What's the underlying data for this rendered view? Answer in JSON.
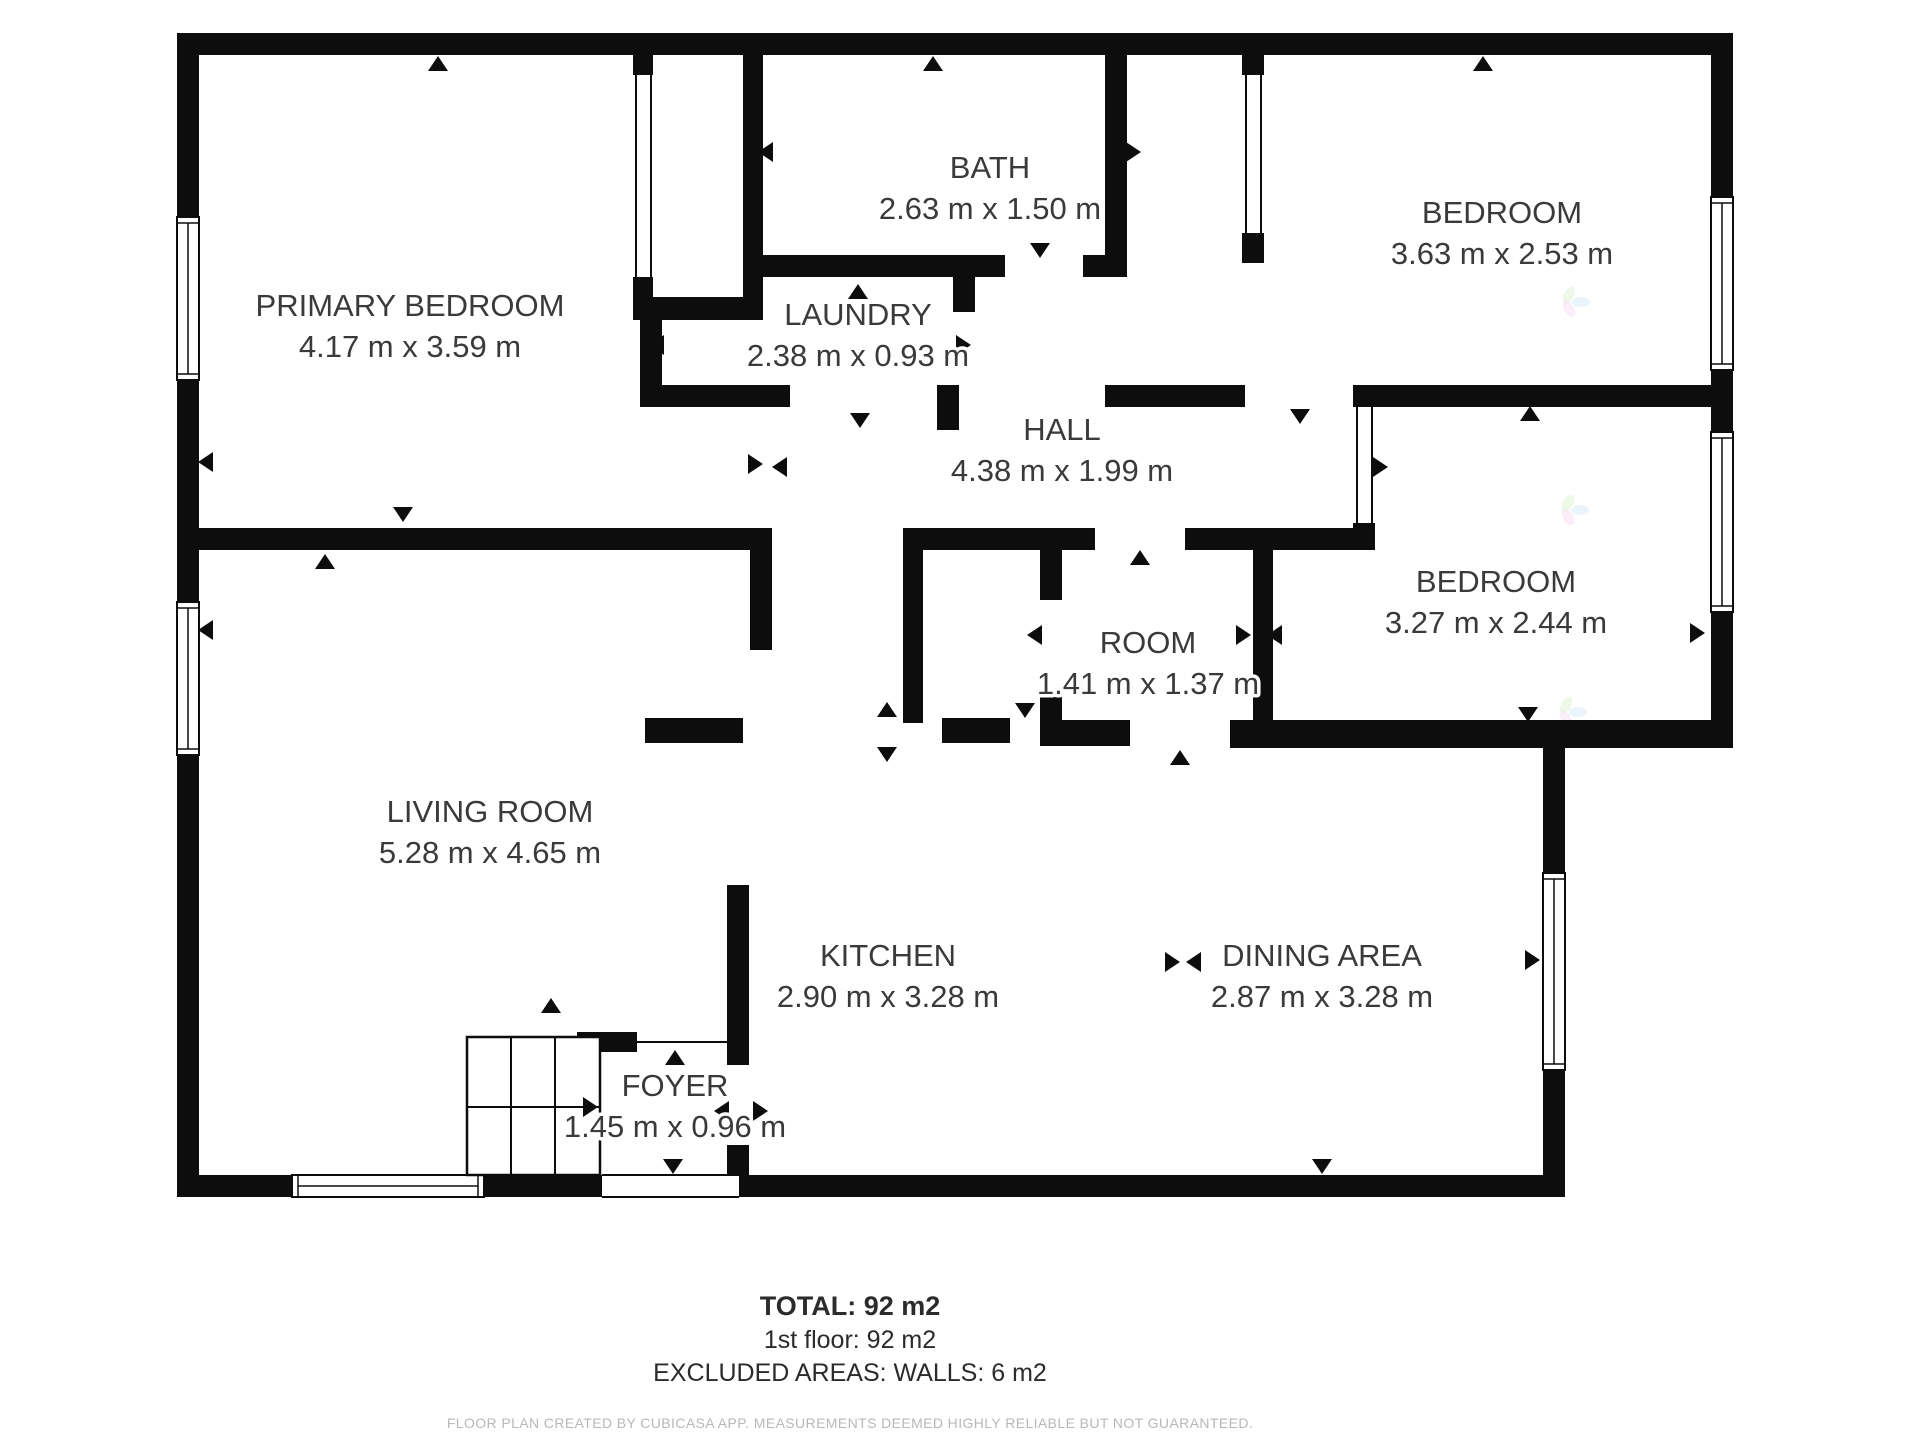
{
  "floorplan": {
    "colors": {
      "wall": "#0d0d0d",
      "background": "#ffffff",
      "label_text": "#3a3a3a",
      "disclaimer_text": "#b8b8b8",
      "watermark_petals": [
        "#cfe8f7",
        "#d9f2cf",
        "#f7d9ef"
      ]
    },
    "rooms": [
      {
        "name": "PRIMARY BEDROOM",
        "dims": "4.17 m x 3.59 m",
        "x": 410,
        "y": 316
      },
      {
        "name": "BATH",
        "dims": "2.63 m x 1.50 m",
        "x": 990,
        "y": 178
      },
      {
        "name": "LAUNDRY",
        "dims": "2.38 m x 0.93 m",
        "x": 858,
        "y": 325
      },
      {
        "name": "BEDROOM",
        "dims": "3.63 m x 2.53 m",
        "x": 1502,
        "y": 223
      },
      {
        "name": "HALL",
        "dims": "4.38 m x 1.99 m",
        "x": 1062,
        "y": 440
      },
      {
        "name": "ROOM",
        "dims": "1.41 m x 1.37 m",
        "x": 1148,
        "y": 653
      },
      {
        "name": "BEDROOM",
        "dims": "3.27 m x 2.44 m",
        "x": 1496,
        "y": 592
      },
      {
        "name": "LIVING ROOM",
        "dims": "5.28 m x 4.65 m",
        "x": 490,
        "y": 822
      },
      {
        "name": "KITCHEN",
        "dims": "2.90 m x 3.28 m",
        "x": 888,
        "y": 966
      },
      {
        "name": "DINING AREA",
        "dims": "2.87 m x 3.28 m",
        "x": 1322,
        "y": 966
      },
      {
        "name": "FOYER",
        "dims": "1.45 m x 0.96 m",
        "x": 675,
        "y": 1096
      }
    ],
    "geometry": {
      "walls": [
        [
          177,
          33,
          1556,
          22
        ],
        [
          177,
          33,
          22,
          1164
        ],
        [
          1711,
          33,
          22,
          715
        ],
        [
          1543,
          726,
          190,
          22
        ],
        [
          1543,
          748,
          22,
          449
        ],
        [
          177,
          1175,
          1388,
          22
        ],
        [
          633,
          55,
          20,
          20
        ],
        [
          633,
          277,
          20,
          22
        ],
        [
          633,
          297,
          130,
          23
        ],
        [
          743,
          55,
          20,
          242
        ],
        [
          763,
          255,
          242,
          22
        ],
        [
          1083,
          255,
          44,
          22
        ],
        [
          1105,
          55,
          22,
          200
        ],
        [
          640,
          320,
          22,
          87
        ],
        [
          640,
          385,
          150,
          22
        ],
        [
          937,
          385,
          22,
          45
        ],
        [
          953,
          277,
          22,
          35
        ],
        [
          1242,
          55,
          22,
          20
        ],
        [
          1242,
          233,
          22,
          30
        ],
        [
          1105,
          385,
          140,
          22
        ],
        [
          1353,
          385,
          380,
          22
        ],
        [
          1353,
          523,
          22,
          27
        ],
        [
          199,
          528,
          573,
          22
        ],
        [
          750,
          528,
          22,
          122
        ],
        [
          903,
          528,
          192,
          22
        ],
        [
          1185,
          528,
          168,
          22
        ],
        [
          903,
          550,
          20,
          173
        ],
        [
          1040,
          550,
          22,
          50
        ],
        [
          1040,
          690,
          22,
          33
        ],
        [
          1253,
          550,
          20,
          176
        ],
        [
          645,
          718,
          98,
          25
        ],
        [
          942,
          718,
          68,
          25
        ],
        [
          1040,
          720,
          90,
          26
        ],
        [
          1230,
          720,
          503,
          28
        ],
        [
          727,
          885,
          22,
          180
        ],
        [
          727,
          1145,
          22,
          30
        ],
        [
          577,
          1032,
          60,
          20
        ]
      ],
      "thin_lines": [
        [
          636,
          73,
          636,
          277
        ],
        [
          651,
          73,
          651,
          277
        ],
        [
          1246,
          73,
          1246,
          233
        ],
        [
          1261,
          73,
          1261,
          233
        ],
        [
          1357,
          407,
          1357,
          523
        ],
        [
          1372,
          407,
          1372,
          523
        ],
        [
          637,
          1042,
          727,
          1042
        ],
        [
          602,
          1175,
          739,
          1175
        ],
        [
          602,
          1197,
          739,
          1197
        ]
      ],
      "door_gaps": [
        [
          602,
          1175,
          137,
          22
        ]
      ],
      "windows": [
        [
          177,
          217,
          22,
          163,
          "v"
        ],
        [
          177,
          602,
          22,
          153,
          "v"
        ],
        [
          1711,
          197,
          22,
          173,
          "v"
        ],
        [
          1711,
          432,
          22,
          180,
          "v"
        ],
        [
          1543,
          873,
          22,
          197,
          "v"
        ],
        [
          292,
          1175,
          192,
          22,
          "h"
        ]
      ],
      "door_arrows": [
        [
          438,
          64,
          "u"
        ],
        [
          933,
          64,
          "u"
        ],
        [
          1483,
          64,
          "u"
        ],
        [
          766,
          152,
          "l"
        ],
        [
          1133,
          152,
          "r"
        ],
        [
          1040,
          250,
          "d"
        ],
        [
          858,
          292,
          "u"
        ],
        [
          657,
          345,
          "l"
        ],
        [
          963,
          345,
          "r"
        ],
        [
          860,
          420,
          "d"
        ],
        [
          755,
          464,
          "r"
        ],
        [
          780,
          467,
          "l"
        ],
        [
          206,
          462,
          "l"
        ],
        [
          206,
          630,
          "l"
        ],
        [
          325,
          562,
          "u"
        ],
        [
          403,
          514,
          "d"
        ],
        [
          1140,
          558,
          "u"
        ],
        [
          1035,
          635,
          "l"
        ],
        [
          1243,
          635,
          "r"
        ],
        [
          1275,
          635,
          "l"
        ],
        [
          1380,
          467,
          "r"
        ],
        [
          1300,
          416,
          "d"
        ],
        [
          1530,
          414,
          "u"
        ],
        [
          1697,
          633,
          "r"
        ],
        [
          1528,
          714,
          "d"
        ],
        [
          887,
          710,
          "u"
        ],
        [
          887,
          754,
          "d"
        ],
        [
          1025,
          710,
          "d"
        ],
        [
          1180,
          758,
          "u"
        ],
        [
          1172,
          962,
          "r"
        ],
        [
          1194,
          962,
          "l"
        ],
        [
          1532,
          960,
          "r"
        ],
        [
          551,
          1006,
          "u"
        ],
        [
          675,
          1058,
          "u"
        ],
        [
          722,
          1111,
          "l"
        ],
        [
          760,
          1111,
          "r"
        ],
        [
          673,
          1166,
          "d"
        ],
        [
          1322,
          1166,
          "d"
        ],
        [
          590,
          1107,
          "r"
        ]
      ],
      "stairs": {
        "x": 467,
        "y": 1037,
        "w": 133,
        "h": 138,
        "vlines": [
          511,
          555
        ],
        "hline": 1107
      },
      "watermarks": [
        [
          1573,
          302
        ],
        [
          1572,
          510
        ],
        [
          1570,
          712
        ]
      ]
    },
    "footer": {
      "total": "TOTAL: 92 m2",
      "floor": "1st floor: 92 m2",
      "excluded": "EXCLUDED AREAS: WALLS: 6 m2",
      "disclaimer": "FLOOR PLAN CREATED BY CUBICASA APP. MEASUREMENTS DEEMED HIGHLY RELIABLE BUT NOT GUARANTEED."
    }
  }
}
